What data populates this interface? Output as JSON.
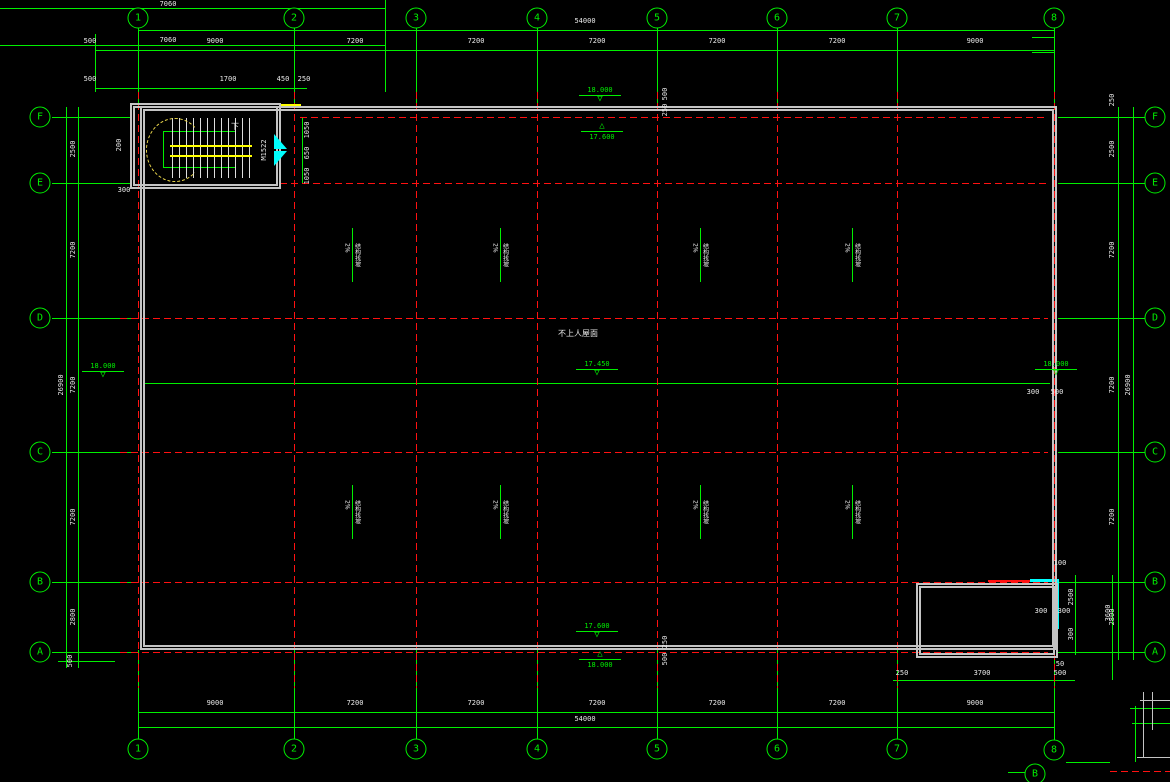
{
  "canvas": {
    "width": 1170,
    "height": 782,
    "background": "#000000"
  },
  "colors": {
    "grid_green": "#00ef00",
    "axis_red": "#ff1111",
    "wall_gray": "#c4c4c4",
    "door_cyan": "#00ffff",
    "stair_yellow": "#ffff00",
    "text_white": "#e9e9e9"
  },
  "grid": {
    "cols": [
      {
        "label": "1",
        "x": 138
      },
      {
        "label": "2",
        "x": 294
      },
      {
        "label": "3",
        "x": 416
      },
      {
        "label": "4",
        "x": 537
      },
      {
        "label": "5",
        "x": 657
      },
      {
        "label": "6",
        "x": 777
      },
      {
        "label": "7",
        "x": 897
      },
      {
        "label": "8",
        "x": 1054
      }
    ],
    "rows": [
      {
        "label": "F",
        "y": 117
      },
      {
        "label": "E",
        "y": 183
      },
      {
        "label": "D",
        "y": 318
      },
      {
        "label": "C",
        "y": 452
      },
      {
        "label": "B",
        "y": 582
      },
      {
        "label": "A",
        "y": 652
      }
    ]
  },
  "bubbles": [
    {
      "t": "1",
      "x": 138,
      "y": 18
    },
    {
      "t": "2",
      "x": 294,
      "y": 18
    },
    {
      "t": "3",
      "x": 416,
      "y": 18
    },
    {
      "t": "4",
      "x": 537,
      "y": 18
    },
    {
      "t": "5",
      "x": 657,
      "y": 18
    },
    {
      "t": "6",
      "x": 777,
      "y": 18
    },
    {
      "t": "7",
      "x": 897,
      "y": 18
    },
    {
      "t": "8",
      "x": 1054,
      "y": 18
    },
    {
      "t": "1",
      "x": 138,
      "y": 749
    },
    {
      "t": "2",
      "x": 294,
      "y": 749
    },
    {
      "t": "3",
      "x": 416,
      "y": 749
    },
    {
      "t": "4",
      "x": 537,
      "y": 749
    },
    {
      "t": "5",
      "x": 657,
      "y": 749
    },
    {
      "t": "6",
      "x": 777,
      "y": 749
    },
    {
      "t": "7",
      "x": 897,
      "y": 749
    },
    {
      "t": "8",
      "x": 1054,
      "y": 750
    },
    {
      "t": "F",
      "x": 40,
      "y": 117
    },
    {
      "t": "E",
      "x": 40,
      "y": 183
    },
    {
      "t": "D",
      "x": 40,
      "y": 318
    },
    {
      "t": "C",
      "x": 40,
      "y": 452
    },
    {
      "t": "B",
      "x": 40,
      "y": 582
    },
    {
      "t": "A",
      "x": 40,
      "y": 652
    },
    {
      "t": "F",
      "x": 1155,
      "y": 117
    },
    {
      "t": "E",
      "x": 1155,
      "y": 183
    },
    {
      "t": "D",
      "x": 1155,
      "y": 318
    },
    {
      "t": "C",
      "x": 1155,
      "y": 452
    },
    {
      "t": "B",
      "x": 1155,
      "y": 582
    },
    {
      "t": "A",
      "x": 1155,
      "y": 652
    },
    {
      "t": "B",
      "x": 1035,
      "y": 774
    }
  ],
  "walls": [
    {
      "x": 140,
      "y": 106,
      "w": 917,
      "h": 544
    },
    {
      "x": 130,
      "y": 103,
      "w": 151,
      "h": 86
    },
    {
      "x": 916,
      "y": 583,
      "w": 142,
      "h": 75
    }
  ],
  "lines": [
    {
      "x": 0,
      "y": 8,
      "w": 385,
      "h": 1,
      "k": "g"
    },
    {
      "x": 0,
      "y": 45,
      "w": 385,
      "h": 1,
      "k": "g"
    },
    {
      "x": 385,
      "y": 0,
      "w": 1,
      "h": 92,
      "k": "g"
    },
    {
      "x": 138,
      "y": 30,
      "w": 916,
      "h": 1,
      "k": "g"
    },
    {
      "x": 95,
      "y": 50,
      "w": 959,
      "h": 1,
      "k": "g"
    },
    {
      "x": 95,
      "y": 88,
      "w": 212,
      "h": 1,
      "k": "g"
    },
    {
      "x": 95,
      "y": 34,
      "w": 1,
      "h": 58,
      "k": "g"
    },
    {
      "x": 1032,
      "y": 37,
      "w": 22,
      "h": 1,
      "k": "g"
    },
    {
      "x": 1032,
      "y": 52,
      "w": 22,
      "h": 1,
      "k": "g"
    },
    {
      "x": 138,
      "y": 28,
      "w": 1,
      "h": 78,
      "k": "g"
    },
    {
      "x": 294,
      "y": 28,
      "w": 1,
      "h": 78,
      "k": "g"
    },
    {
      "x": 416,
      "y": 28,
      "w": 1,
      "h": 78,
      "k": "g"
    },
    {
      "x": 537,
      "y": 28,
      "w": 1,
      "h": 78,
      "k": "g"
    },
    {
      "x": 657,
      "y": 28,
      "w": 1,
      "h": 78,
      "k": "g"
    },
    {
      "x": 777,
      "y": 28,
      "w": 1,
      "h": 78,
      "k": "g"
    },
    {
      "x": 897,
      "y": 28,
      "w": 1,
      "h": 78,
      "k": "g"
    },
    {
      "x": 1054,
      "y": 28,
      "w": 1,
      "h": 78,
      "k": "g"
    },
    {
      "x": 138,
      "y": 650,
      "w": 1,
      "h": 90,
      "k": "g"
    },
    {
      "x": 294,
      "y": 650,
      "w": 1,
      "h": 90,
      "k": "g"
    },
    {
      "x": 416,
      "y": 650,
      "w": 1,
      "h": 90,
      "k": "g"
    },
    {
      "x": 537,
      "y": 650,
      "w": 1,
      "h": 90,
      "k": "g"
    },
    {
      "x": 657,
      "y": 650,
      "w": 1,
      "h": 90,
      "k": "g"
    },
    {
      "x": 777,
      "y": 650,
      "w": 1,
      "h": 90,
      "k": "g"
    },
    {
      "x": 897,
      "y": 650,
      "w": 1,
      "h": 90,
      "k": "g"
    },
    {
      "x": 1054,
      "y": 658,
      "w": 1,
      "h": 82,
      "k": "g"
    },
    {
      "x": 52,
      "y": 117,
      "w": 80,
      "h": 1,
      "k": "g"
    },
    {
      "x": 52,
      "y": 183,
      "w": 80,
      "h": 1,
      "k": "g"
    },
    {
      "x": 52,
      "y": 318,
      "w": 86,
      "h": 1,
      "k": "g"
    },
    {
      "x": 52,
      "y": 452,
      "w": 86,
      "h": 1,
      "k": "g"
    },
    {
      "x": 52,
      "y": 582,
      "w": 86,
      "h": 1,
      "k": "g"
    },
    {
      "x": 52,
      "y": 652,
      "w": 86,
      "h": 1,
      "k": "g"
    },
    {
      "x": 1058,
      "y": 117,
      "w": 88,
      "h": 1,
      "k": "g"
    },
    {
      "x": 1058,
      "y": 183,
      "w": 88,
      "h": 1,
      "k": "g"
    },
    {
      "x": 1058,
      "y": 318,
      "w": 88,
      "h": 1,
      "k": "g"
    },
    {
      "x": 1058,
      "y": 452,
      "w": 88,
      "h": 1,
      "k": "g"
    },
    {
      "x": 1058,
      "y": 582,
      "w": 88,
      "h": 1,
      "k": "g"
    },
    {
      "x": 1058,
      "y": 652,
      "w": 88,
      "h": 1,
      "k": "g"
    },
    {
      "x": 66,
      "y": 107,
      "w": 1,
      "h": 561,
      "k": "g"
    },
    {
      "x": 78,
      "y": 107,
      "w": 1,
      "h": 561,
      "k": "g"
    },
    {
      "x": 58,
      "y": 661,
      "w": 57,
      "h": 1,
      "k": "g"
    },
    {
      "x": 1118,
      "y": 107,
      "w": 1,
      "h": 553,
      "k": "g"
    },
    {
      "x": 1133,
      "y": 107,
      "w": 1,
      "h": 553,
      "k": "g"
    },
    {
      "x": 138,
      "y": 712,
      "w": 916,
      "h": 1,
      "k": "g"
    },
    {
      "x": 138,
      "y": 727,
      "w": 916,
      "h": 1,
      "k": "g"
    },
    {
      "x": 145,
      "y": 383,
      "w": 905,
      "h": 1,
      "k": "g"
    },
    {
      "x": 352,
      "y": 228,
      "w": 1,
      "h": 54,
      "k": "g"
    },
    {
      "x": 500,
      "y": 228,
      "w": 1,
      "h": 54,
      "k": "g"
    },
    {
      "x": 700,
      "y": 228,
      "w": 1,
      "h": 54,
      "k": "g"
    },
    {
      "x": 852,
      "y": 228,
      "w": 1,
      "h": 54,
      "k": "g"
    },
    {
      "x": 352,
      "y": 485,
      "w": 1,
      "h": 54,
      "k": "g"
    },
    {
      "x": 500,
      "y": 485,
      "w": 1,
      "h": 54,
      "k": "g"
    },
    {
      "x": 700,
      "y": 485,
      "w": 1,
      "h": 54,
      "k": "g"
    },
    {
      "x": 852,
      "y": 485,
      "w": 1,
      "h": 54,
      "k": "g"
    },
    {
      "x": 163,
      "y": 131,
      "w": 72,
      "h": 1,
      "k": "g"
    },
    {
      "x": 163,
      "y": 131,
      "w": 1,
      "h": 36,
      "k": "g"
    },
    {
      "x": 163,
      "y": 167,
      "w": 72,
      "h": 1,
      "k": "g"
    },
    {
      "x": 302,
      "y": 117,
      "w": 1,
      "h": 66,
      "k": "g"
    },
    {
      "x": 893,
      "y": 680,
      "w": 182,
      "h": 1,
      "k": "g"
    },
    {
      "x": 1075,
      "y": 575,
      "w": 1,
      "h": 80,
      "k": "g"
    },
    {
      "x": 1112,
      "y": 575,
      "w": 1,
      "h": 105,
      "k": "g"
    },
    {
      "x": 1135,
      "y": 706,
      "w": 1,
      "h": 56,
      "k": "g"
    },
    {
      "x": 1130,
      "y": 708,
      "w": 40,
      "h": 1,
      "k": "g"
    },
    {
      "x": 1132,
      "y": 723,
      "w": 38,
      "h": 1,
      "k": "g"
    },
    {
      "x": 1066,
      "y": 762,
      "w": 44,
      "h": 1,
      "k": "g"
    },
    {
      "x": 1008,
      "y": 772,
      "w": 28,
      "h": 1,
      "k": "g"
    },
    {
      "x": 138,
      "y": 92,
      "w": 1,
      "h": 596,
      "k": "rdv"
    },
    {
      "x": 294,
      "y": 92,
      "w": 1,
      "h": 596,
      "k": "rdv"
    },
    {
      "x": 416,
      "y": 92,
      "w": 1,
      "h": 596,
      "k": "rdv"
    },
    {
      "x": 537,
      "y": 92,
      "w": 1,
      "h": 596,
      "k": "rdv"
    },
    {
      "x": 657,
      "y": 92,
      "w": 1,
      "h": 596,
      "k": "rdv"
    },
    {
      "x": 777,
      "y": 92,
      "w": 1,
      "h": 596,
      "k": "rdv"
    },
    {
      "x": 897,
      "y": 92,
      "w": 1,
      "h": 596,
      "k": "rdv"
    },
    {
      "x": 1054,
      "y": 92,
      "w": 1,
      "h": 596,
      "k": "rdv"
    },
    {
      "x": 300,
      "y": 117,
      "w": 748,
      "h": 1,
      "k": "rd"
    },
    {
      "x": 280,
      "y": 183,
      "w": 768,
      "h": 1,
      "k": "rd"
    },
    {
      "x": 120,
      "y": 318,
      "w": 928,
      "h": 1,
      "k": "rd"
    },
    {
      "x": 120,
      "y": 452,
      "w": 928,
      "h": 1,
      "k": "rd"
    },
    {
      "x": 120,
      "y": 582,
      "w": 928,
      "h": 1,
      "k": "rd"
    },
    {
      "x": 120,
      "y": 652,
      "w": 928,
      "h": 1,
      "k": "rd"
    },
    {
      "x": 988,
      "y": 580,
      "w": 70,
      "h": 2,
      "k": "rs"
    },
    {
      "x": 1110,
      "y": 771,
      "w": 60,
      "h": 1,
      "k": "rd"
    },
    {
      "x": 1143,
      "y": 692,
      "w": 1,
      "h": 66,
      "k": "w"
    },
    {
      "x": 1152,
      "y": 692,
      "w": 1,
      "h": 38,
      "k": "w"
    },
    {
      "x": 1137,
      "y": 757,
      "w": 33,
      "h": 1,
      "k": "w"
    },
    {
      "x": 1140,
      "y": 700,
      "w": 30,
      "h": 1,
      "k": "w"
    },
    {
      "x": 281,
      "y": 104,
      "w": 20,
      "h": 2,
      "k": "y"
    },
    {
      "x": 172,
      "y": 118,
      "w": 78,
      "h": 60,
      "k": "treads"
    },
    {
      "x": 170,
      "y": 145,
      "w": 82,
      "h": 8,
      "k": "band"
    },
    {
      "x": 146,
      "y": 118,
      "w": 56,
      "h": 62,
      "k": "arc"
    },
    {
      "x": 1030,
      "y": 579,
      "w": 29,
      "h": 3,
      "k": "c"
    },
    {
      "x": 1055,
      "y": 579,
      "w": 4,
      "h": 50,
      "k": "c"
    }
  ],
  "texts": [
    {
      "t": "9000",
      "x": 215,
      "y": 41
    },
    {
      "t": "7200",
      "x": 355,
      "y": 41
    },
    {
      "t": "7200",
      "x": 476,
      "y": 41
    },
    {
      "t": "7200",
      "x": 597,
      "y": 41
    },
    {
      "t": "7200",
      "x": 717,
      "y": 41
    },
    {
      "t": "7200",
      "x": 837,
      "y": 41
    },
    {
      "t": "9000",
      "x": 975,
      "y": 41
    },
    {
      "t": "54000",
      "x": 585,
      "y": 21
    },
    {
      "t": "500",
      "x": 90,
      "y": 41
    },
    {
      "t": "500",
      "x": 90,
      "y": 79
    },
    {
      "t": "1700",
      "x": 228,
      "y": 79
    },
    {
      "t": "450",
      "x": 283,
      "y": 79
    },
    {
      "t": "250",
      "x": 304,
      "y": 79
    },
    {
      "t": "7060",
      "x": 168,
      "y": 4
    },
    {
      "t": "7060",
      "x": 168,
      "y": 40
    },
    {
      "t": "9000",
      "x": 215,
      "y": 703
    },
    {
      "t": "7200",
      "x": 355,
      "y": 703
    },
    {
      "t": "7200",
      "x": 476,
      "y": 703
    },
    {
      "t": "7200",
      "x": 597,
      "y": 703
    },
    {
      "t": "7200",
      "x": 717,
      "y": 703
    },
    {
      "t": "7200",
      "x": 837,
      "y": 703
    },
    {
      "t": "9000",
      "x": 975,
      "y": 703
    },
    {
      "t": "54000",
      "x": 585,
      "y": 719
    },
    {
      "t": "2500",
      "x": 73,
      "y": 149,
      "k": "rot"
    },
    {
      "t": "7200",
      "x": 73,
      "y": 250,
      "k": "rot"
    },
    {
      "t": "7200",
      "x": 73,
      "y": 385,
      "k": "rot"
    },
    {
      "t": "7200",
      "x": 73,
      "y": 517,
      "k": "rot"
    },
    {
      "t": "2800",
      "x": 73,
      "y": 617,
      "k": "rot"
    },
    {
      "t": "26900",
      "x": 61,
      "y": 385,
      "k": "rot"
    },
    {
      "t": "500",
      "x": 70,
      "y": 661,
      "k": "rot"
    },
    {
      "t": "2500",
      "x": 1112,
      "y": 149,
      "k": "rot"
    },
    {
      "t": "7200",
      "x": 1112,
      "y": 250,
      "k": "rot"
    },
    {
      "t": "7200",
      "x": 1112,
      "y": 385,
      "k": "rot"
    },
    {
      "t": "7200",
      "x": 1112,
      "y": 517,
      "k": "rot"
    },
    {
      "t": "2800",
      "x": 1112,
      "y": 617,
      "k": "rot"
    },
    {
      "t": "26900",
      "x": 1128,
      "y": 385,
      "k": "rot"
    },
    {
      "t": "250",
      "x": 1112,
      "y": 100,
      "k": "rot"
    },
    {
      "t": "200",
      "x": 119,
      "y": 145,
      "k": "rot"
    },
    {
      "t": "300",
      "x": 124,
      "y": 190
    },
    {
      "t": "1050",
      "x": 307,
      "y": 130,
      "k": "rot"
    },
    {
      "t": "650",
      "x": 307,
      "y": 153,
      "k": "rot"
    },
    {
      "t": "1050",
      "x": 307,
      "y": 176,
      "k": "rot"
    },
    {
      "t": "M1522",
      "x": 264,
      "y": 150,
      "k": "rot"
    },
    {
      "t": "下",
      "x": 235,
      "y": 127,
      "k": "cjk"
    },
    {
      "t": "500",
      "x": 665,
      "y": 94,
      "k": "rot"
    },
    {
      "t": "250",
      "x": 665,
      "y": 110,
      "k": "rot"
    },
    {
      "t": "250",
      "x": 665,
      "y": 642,
      "k": "rot"
    },
    {
      "t": "500",
      "x": 665,
      "y": 659,
      "k": "rot"
    },
    {
      "t": "300",
      "x": 1033,
      "y": 392
    },
    {
      "t": "500",
      "x": 1057,
      "y": 392
    },
    {
      "t": "100",
      "x": 1060,
      "y": 563
    },
    {
      "t": "2500",
      "x": 1071,
      "y": 597,
      "k": "rot"
    },
    {
      "t": "300",
      "x": 1071,
      "y": 634,
      "k": "rot"
    },
    {
      "t": "300",
      "x": 1041,
      "y": 611
    },
    {
      "t": "300",
      "x": 1064,
      "y": 611
    },
    {
      "t": "3600",
      "x": 1108,
      "y": 613,
      "k": "rot"
    },
    {
      "t": "250",
      "x": 902,
      "y": 673
    },
    {
      "t": "3700",
      "x": 982,
      "y": 673
    },
    {
      "t": "500",
      "x": 1060,
      "y": 673
    },
    {
      "t": "50",
      "x": 1060,
      "y": 664
    },
    {
      "t": "50",
      "x": 1060,
      "y": 752
    },
    {
      "t": "不上人屋面",
      "x": 578,
      "y": 334,
      "k": "cjk"
    }
  ],
  "slopes": [
    {
      "p": "2%",
      "l": "结构找坡",
      "x": 352,
      "y": 255
    },
    {
      "p": "2%",
      "l": "结构找坡",
      "x": 500,
      "y": 255
    },
    {
      "p": "2%",
      "l": "结构找坡",
      "x": 700,
      "y": 255
    },
    {
      "p": "2%",
      "l": "结构找坡",
      "x": 852,
      "y": 255
    },
    {
      "p": "2%",
      "l": "结构找坡",
      "x": 352,
      "y": 512
    },
    {
      "p": "2%",
      "l": "结构找坡",
      "x": 500,
      "y": 512
    },
    {
      "p": "2%",
      "l": "结构找坡",
      "x": 700,
      "y": 512
    },
    {
      "p": "2%",
      "l": "结构找坡",
      "x": 852,
      "y": 512
    }
  ],
  "elevations": [
    {
      "label": "18.000",
      "g": "▽",
      "x": 600,
      "y": 86
    },
    {
      "label": "17.600",
      "g": "△",
      "x": 602,
      "y": 124,
      "k": "flip"
    },
    {
      "label": "18.000",
      "g": "▽",
      "x": 103,
      "y": 362
    },
    {
      "label": "18.000",
      "g": "▽",
      "x": 1056,
      "y": 360
    },
    {
      "label": "17.450",
      "g": "▽",
      "x": 597,
      "y": 360
    },
    {
      "label": "17.600",
      "g": "▽",
      "x": 597,
      "y": 622
    },
    {
      "label": "18.000",
      "g": "△",
      "x": 600,
      "y": 652,
      "k": "flip"
    }
  ],
  "doors": [
    {
      "x": 274,
      "y": 134,
      "k": "tri-a"
    },
    {
      "x": 274,
      "y": 151,
      "k": "tri-b"
    }
  ]
}
